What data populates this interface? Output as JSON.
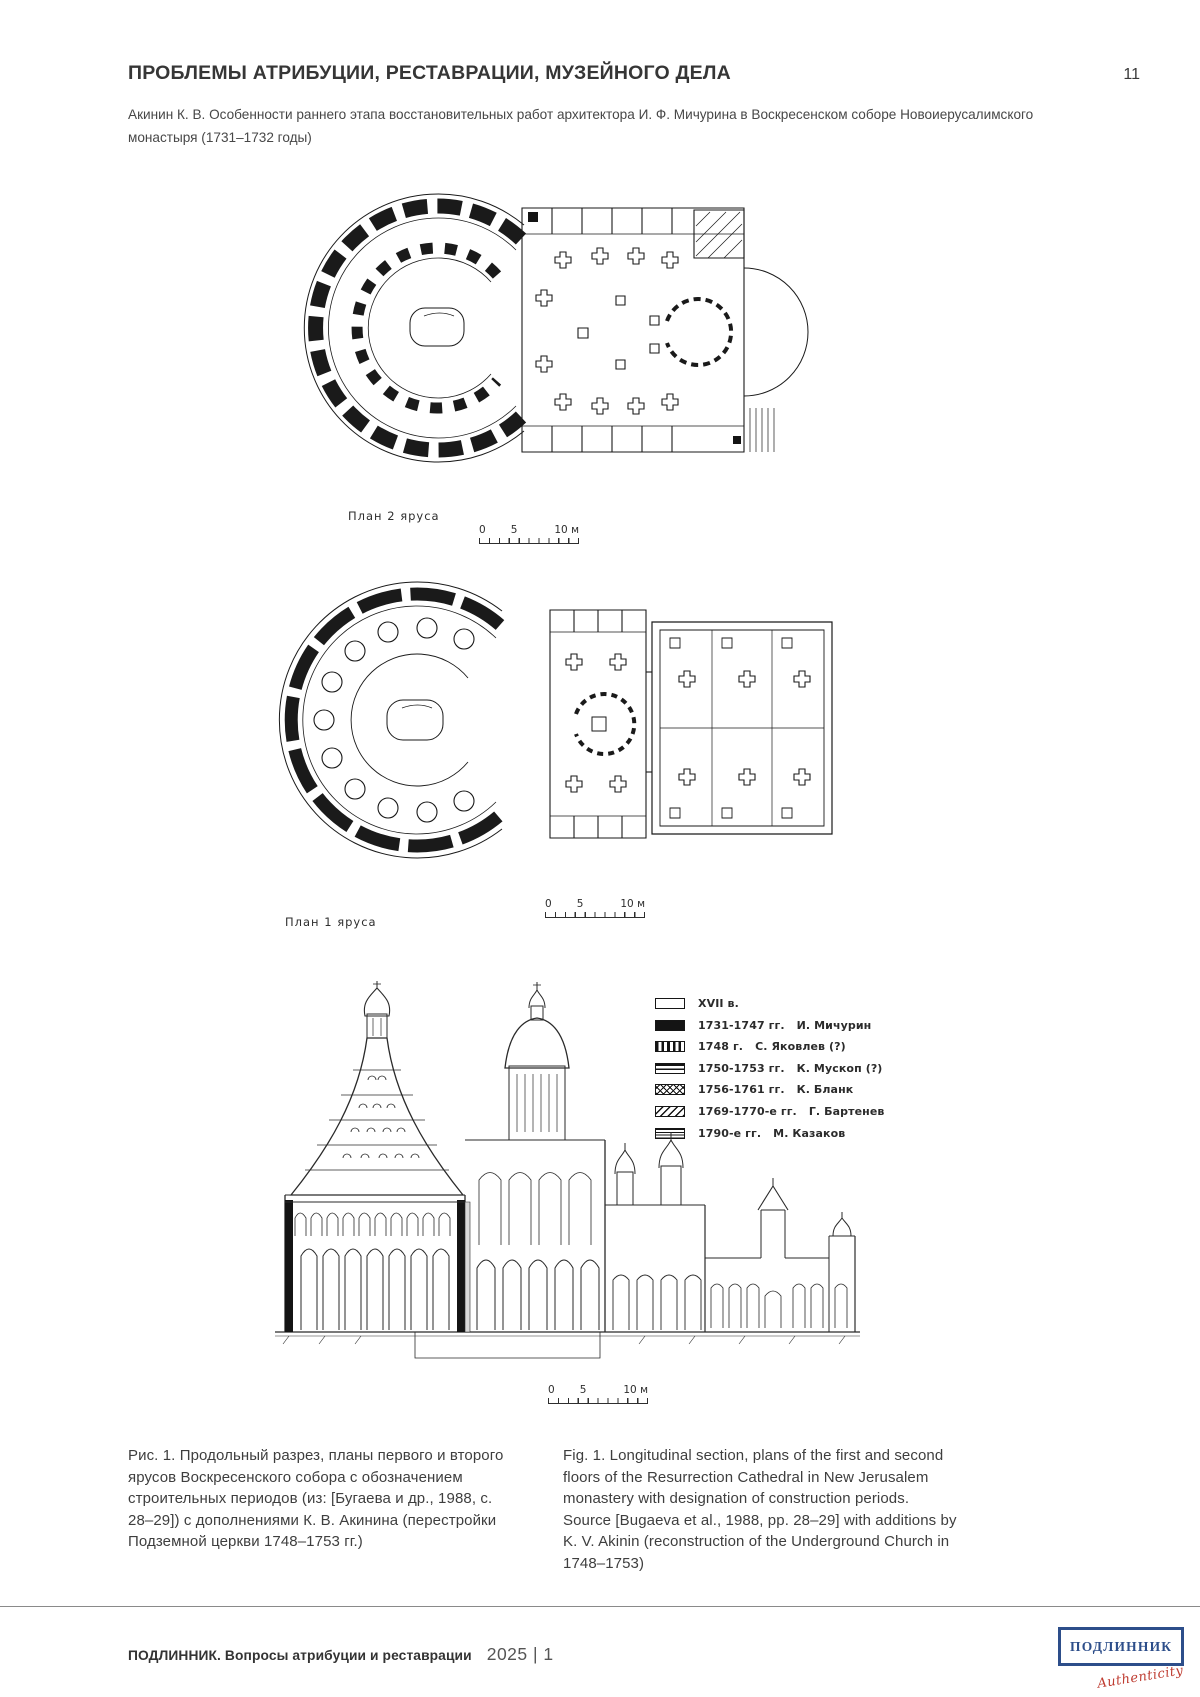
{
  "page": {
    "number": "11",
    "header_title": "ПРОБЛЕМЫ АТРИБУЦИИ, РЕСТАВРАЦИИ, МУЗЕЙНОГО ДЕЛА",
    "article_ref": "Акинин К. В. Особенности раннего этапа восстановительных работ архитектора И. Ф. Мичурина в Воскресенском соборе Новоиерусалимского монастыря (1731–1732 годы)"
  },
  "figure": {
    "plan2_label": "План 2 яруса",
    "plan1_label": "План 1 яруса",
    "scale": {
      "zero": "0",
      "five": "5",
      "ten": "10 м"
    },
    "legend": {
      "items": [
        {
          "years": "XVII в.",
          "name": "",
          "pattern": "white"
        },
        {
          "years": "1731-1747 гг.",
          "name": "И. Мичурин",
          "pattern": "solid"
        },
        {
          "years": "1748 г.",
          "name": "С. Яковлев (?)",
          "pattern": "vertical-stripes"
        },
        {
          "years": "1750-1753 гг.",
          "name": "К. Мускоп (?)",
          "pattern": "horizontal-stripes"
        },
        {
          "years": "1756-1761 гг.",
          "name": "К. Бланк",
          "pattern": "crosshatch"
        },
        {
          "years": "1769-1770-е гг.",
          "name": "Г. Бартенев",
          "pattern": "diagonal-stripes"
        },
        {
          "years": "1790-е гг.",
          "name": "М. Казаков",
          "pattern": "fine-horizontal-stripes"
        }
      ]
    },
    "caption_ru": "Рис. 1. Продольный разрез, планы первого и второго ярусов Воскресенского собора с обозначением строительных периодов (из: [Бугаева и др., 1988, с. 28–29]) с дополнениями К. В. Акинина (перестройки Подземной церкви 1748–1753 гг.)",
    "caption_en": "Fig. 1. Longitudinal section, plans of the first and second floors of the Resurrection Cathedral in New Jerusalem monastery with designation of construction periods. Source [Bugaeva et al., 1988, pp. 28–29] with additions by K. V. Akinin (reconstruction of the Underground Church in 1748–1753)"
  },
  "footer": {
    "journal": "ПОДЛИННИК. Вопросы атрибуции и реставрации",
    "issue": "2025 | 1",
    "logo_text": "ПОДЛИННИК",
    "logo_script": "Authenticity",
    "logo_border_color": "#2d4e8a",
    "logo_script_color": "#bf3d32"
  }
}
